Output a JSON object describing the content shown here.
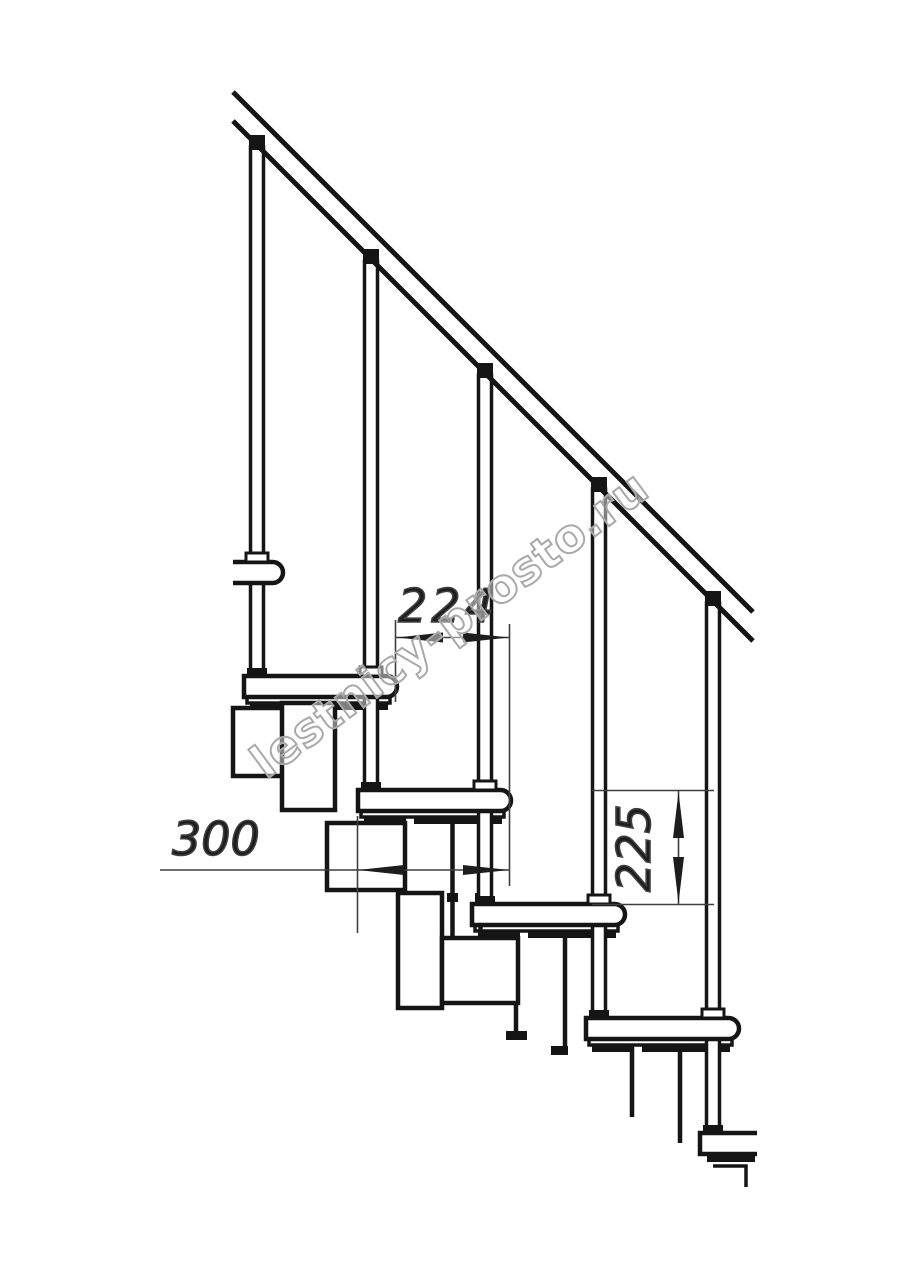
{
  "drawing": {
    "watermark": {
      "text": "lestnicy-prosto.ru"
    },
    "dimensions": {
      "tread_spacing": {
        "value": "224"
      },
      "tread_depth": {
        "value": "300"
      },
      "step_rise": {
        "value": "225"
      }
    },
    "colors": {
      "line": "#151515",
      "dimension": "#3f3f3f",
      "watermark": "#a9a9a9",
      "background": "#ffffff"
    }
  }
}
